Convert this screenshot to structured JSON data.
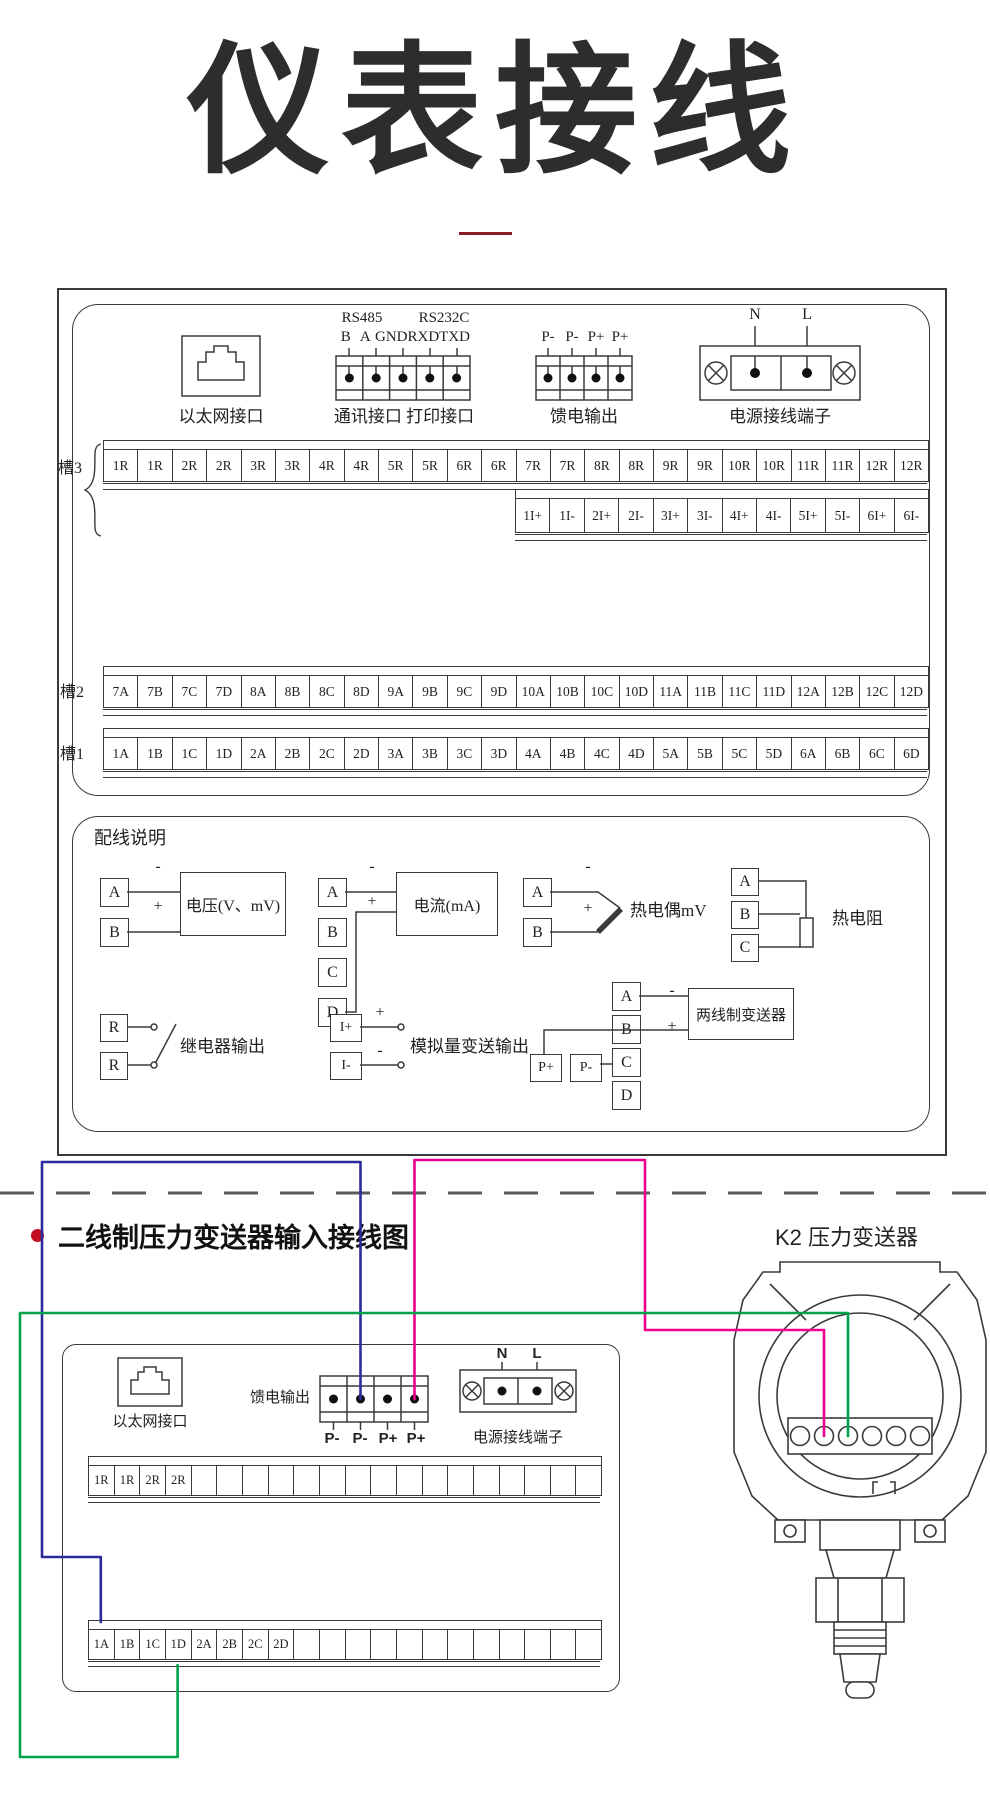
{
  "page": {
    "title": "仪表接线"
  },
  "colors": {
    "accent_red": "#c30d23",
    "underline_red": "#8b1c24",
    "wire_blue": "#2b2b9e",
    "wire_green": "#00a14b",
    "wire_magenta": "#ec008c",
    "line": "#3a3a3a"
  },
  "top_panel": {
    "ethernet_label": "以太网接口",
    "comm": {
      "rs485": "RS485",
      "rs232c": "RS232C",
      "pins": [
        "B",
        "A",
        "GND",
        "RXD",
        "TXD"
      ],
      "caption": "通讯接口 打印接口"
    },
    "feed": {
      "pins": [
        "P-",
        "P-",
        "P+",
        "P+"
      ],
      "caption": "馈电输出"
    },
    "power": {
      "n": "N",
      "l": "L",
      "caption": "电源接线端子"
    },
    "slot3": {
      "label": "槽3",
      "cells": [
        "1R",
        "1R",
        "2R",
        "2R",
        "3R",
        "3R",
        "4R",
        "4R",
        "5R",
        "5R",
        "6R",
        "6R",
        "7R",
        "7R",
        "8R",
        "8R",
        "9R",
        "9R",
        "10R",
        "10R",
        "11R",
        "11R",
        "12R",
        "12R"
      ]
    },
    "slot3_current": {
      "cells": [
        "1I+",
        "1I-",
        "2I+",
        "2I-",
        "3I+",
        "3I-",
        "4I+",
        "4I-",
        "5I+",
        "5I-",
        "6I+",
        "6I-"
      ]
    },
    "slot2": {
      "label": "槽2",
      "cells": [
        "7A",
        "7B",
        "7C",
        "7D",
        "8A",
        "8B",
        "8C",
        "8D",
        "9A",
        "9B",
        "9C",
        "9D",
        "10A",
        "10B",
        "10C",
        "10D",
        "11A",
        "11B",
        "11C",
        "11D",
        "12A",
        "12B",
        "12C",
        "12D"
      ]
    },
    "slot1": {
      "label": "槽1",
      "cells": [
        "1A",
        "1B",
        "1C",
        "1D",
        "2A",
        "2B",
        "2C",
        "2D",
        "3A",
        "3B",
        "3C",
        "3D",
        "4A",
        "4B",
        "4C",
        "4D",
        "5A",
        "5B",
        "5C",
        "5D",
        "6A",
        "6B",
        "6C",
        "6D"
      ]
    }
  },
  "wiring_notes": {
    "heading": "配线说明",
    "voltage": {
      "a": "A",
      "b": "B",
      "minus": "-",
      "plus": "+",
      "label": "电压(V、mV)"
    },
    "current": {
      "a": "A",
      "b": "B",
      "c": "C",
      "d": "D",
      "minus": "-",
      "plus": "+",
      "label": "电流(mA)"
    },
    "thermocouple": {
      "a": "A",
      "b": "B",
      "minus": "-",
      "plus": "+",
      "label": "热电偶mV"
    },
    "rtd": {
      "a": "A",
      "b": "B",
      "c": "C",
      "label": "热电阻"
    },
    "relay": {
      "r1": "R",
      "r2": "R",
      "label": "继电器输出"
    },
    "analog_out": {
      "i_plus": "I+",
      "i_minus": "I-",
      "plus": "+",
      "minus": "-",
      "label": "模拟量变送输出"
    },
    "two_wire": {
      "a": "A",
      "b": "B",
      "c": "C",
      "d": "D",
      "p_plus": "P+",
      "p_minus": "P-",
      "minus": "-",
      "plus": "+",
      "label": "两线制变送器"
    }
  },
  "bottom_section": {
    "heading": "二线制压力变送器输入接线图",
    "k2_label": "K2 压力变送器",
    "device": {
      "ethernet_label": "以太网接口",
      "feed_caption": "馈电输出",
      "feed_pins": [
        "P-",
        "P-",
        "P+",
        "P+"
      ],
      "power": {
        "n": "N",
        "l": "L",
        "caption": "电源接线端子"
      },
      "strip_top_cells": [
        "1R",
        "1R",
        "2R",
        "2R",
        "",
        "",
        "",
        "",
        "",
        "",
        "",
        "",
        "",
        "",
        "",
        "",
        "",
        "",
        "",
        ""
      ],
      "strip_bottom_cells": [
        "1A",
        "1B",
        "1C",
        "1D",
        "2A",
        "2B",
        "2C",
        "2D",
        "",
        "",
        "",
        "",
        "",
        "",
        "",
        "",
        "",
        "",
        "",
        ""
      ]
    },
    "transmitter": {
      "signs": [
        "+",
        "-",
        "+",
        "-"
      ],
      "letters": [
        "A",
        "B",
        "A"
      ]
    }
  }
}
